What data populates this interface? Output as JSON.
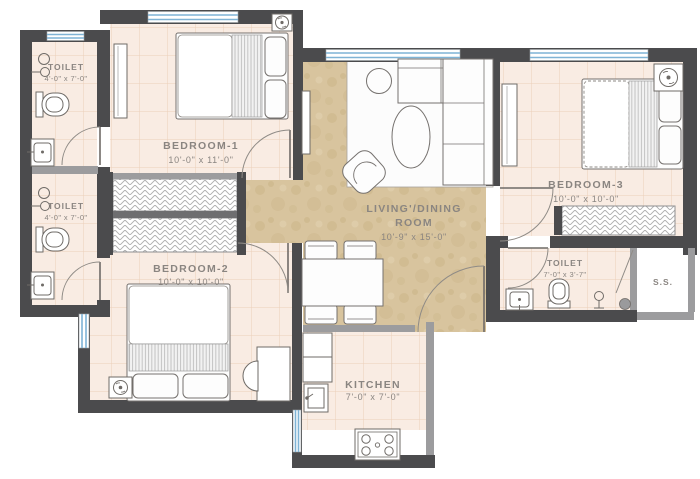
{
  "plan": {
    "type": "apartment-floor-plan",
    "rooms": {
      "toilet1": {
        "label": "TOILET",
        "dims": "4'-0\" x 7'-0\""
      },
      "toilet2": {
        "label": "TOILET",
        "dims": "4'-0\" x 7'-0\""
      },
      "bedroom1": {
        "label": "BEDROOM-1",
        "dims": "10'-0\" x 11'-0\""
      },
      "bedroom2": {
        "label": "BEDROOM-2",
        "dims": "10'-0\" x 10'-0\""
      },
      "bedroom3": {
        "label": "BEDROOM-3",
        "dims": "10'-0\" x 10'-0\""
      },
      "living": {
        "label_line1": "LIVING'/DINING",
        "label_line2": "ROOM",
        "dims": "10'-9\" x 15'-0\""
      },
      "kitchen": {
        "label": "KITCHEN",
        "dims": "7'-0\" x 7'-0\""
      },
      "toilet3": {
        "label": "TOILET",
        "dims": "7'-0\" x 3'-7\""
      },
      "service": {
        "label": "S.S."
      }
    },
    "icons": {
      "double-bed": "bed with duvet, runner and pillows",
      "wardrobe": "hatched sliding wardrobe strip",
      "sofa": "L-shaped sectional sofa",
      "armchair": "tub chair",
      "coffee-table": "oval table",
      "side-table": "round table",
      "dining-table": "4-seat rectangular table",
      "ac-unit": "fan symbol in box",
      "wc": "toilet pan",
      "washbasin": "basin square",
      "shower": "shower head symbol",
      "kitchen-sink": "sink with tap",
      "stove": "4-burner hob",
      "door": "quarter-circle swing",
      "window": "double blue line in wall"
    },
    "colors": {
      "wall": "#4b4b4d",
      "wall_light": "#9c9c9e",
      "floor_room": "#f9ece3",
      "floor_tile_line": "#e8c9b4",
      "floor_living": "#d8c49e",
      "window_glass": "#7fb3d5",
      "furniture_outline": "#75716e",
      "label_text": "#8a8581",
      "rug": "#ffffff"
    }
  }
}
